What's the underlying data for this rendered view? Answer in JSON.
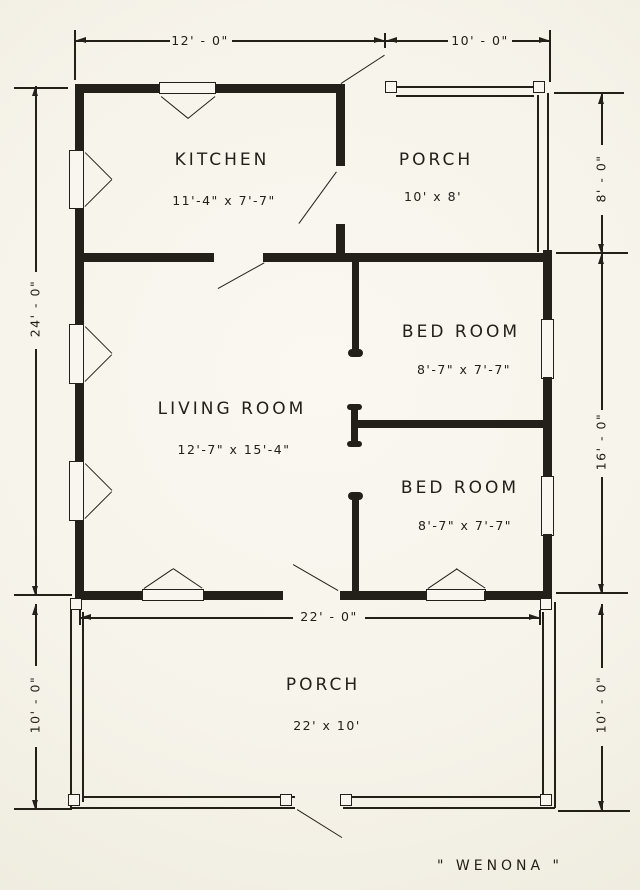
{
  "title": "\" WENONA \"",
  "rooms": [
    {
      "id": "kitchen",
      "name": "KITCHEN",
      "size": "11'-4\" x 7'-7\""
    },
    {
      "id": "porch-top",
      "name": "PORCH",
      "size": "10' x 8'"
    },
    {
      "id": "bedroom-1",
      "name": "BED ROOM",
      "size": "8'-7\" x 7'-7\""
    },
    {
      "id": "living-room",
      "name": "LIVING ROOM",
      "size": "12'-7\" x 15'-4\""
    },
    {
      "id": "bedroom-2",
      "name": "BED ROOM",
      "size": "8'-7\" x 7'-7\""
    },
    {
      "id": "porch-bottom",
      "name": "PORCH",
      "size": "22' x 10'"
    }
  ],
  "dimensions": {
    "top_left": "12' - 0\"",
    "top_right": "10' - 0\"",
    "left_main": "24' - 0\"",
    "left_porch": "10' - 0\"",
    "right_top": "8' - 0\"",
    "right_middle": "16' - 0\"",
    "right_porch": "10' - 0\"",
    "porch_width": "22' - 0\""
  },
  "colors": {
    "ink": "#232019",
    "paper": "#f8f6ee"
  }
}
